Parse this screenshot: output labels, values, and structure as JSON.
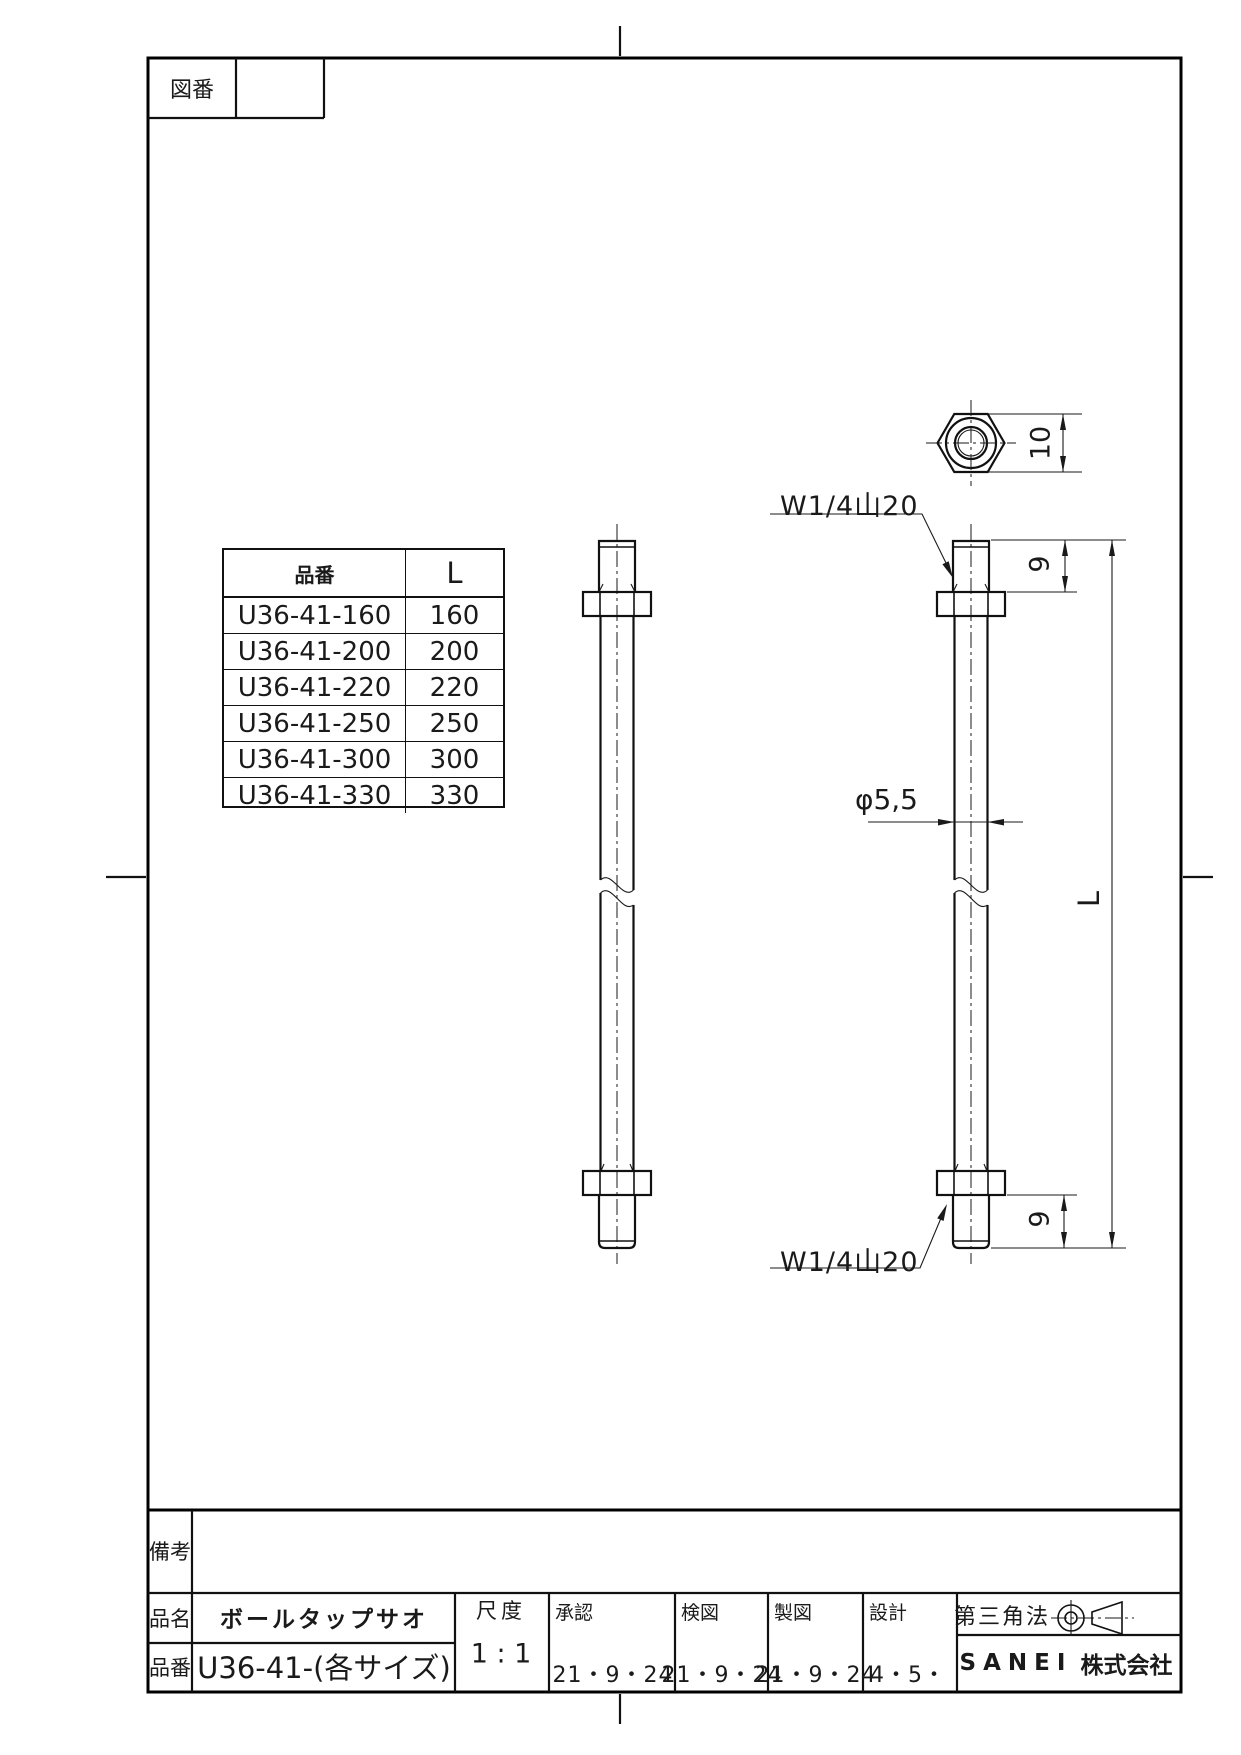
{
  "drawing_header": {
    "label": "図番"
  },
  "size_table": {
    "col_headers": [
      "品番",
      "L"
    ],
    "rows": [
      {
        "code": "U36-41-160",
        "length": "160"
      },
      {
        "code": "U36-41-200",
        "length": "200"
      },
      {
        "code": "U36-41-220",
        "length": "220"
      },
      {
        "code": "U36-41-250",
        "length": "250"
      },
      {
        "code": "U36-41-300",
        "length": "300"
      },
      {
        "code": "U36-41-330",
        "length": "330"
      }
    ]
  },
  "annotations": {
    "thread_spec_top": "W1/4山20",
    "thread_spec_bottom": "W1/4山20",
    "shaft_diameter": "φ5,5",
    "nut_across_flats": "10",
    "thread_length_top": "9",
    "thread_length_bottom": "9",
    "overall_length": "L"
  },
  "title_block": {
    "remarks_label": "備考",
    "product_name_label": "品名",
    "product_name": "ボールタップサオ",
    "part_no_label": "品番",
    "part_no": "U36-41-(各サイズ)",
    "scale_label": "尺度",
    "scale_value": "1 : 1",
    "approval_label": "承認",
    "approval_date": "21・9・24",
    "check_label": "検図",
    "check_date": "21・9・24",
    "draft_label": "製図",
    "draft_date": "21・9・24",
    "design_label": "設計",
    "design_date": "4・5・",
    "projection_label": "第三角法",
    "company_en": "SANEI",
    "company_jp": "株式会社"
  }
}
